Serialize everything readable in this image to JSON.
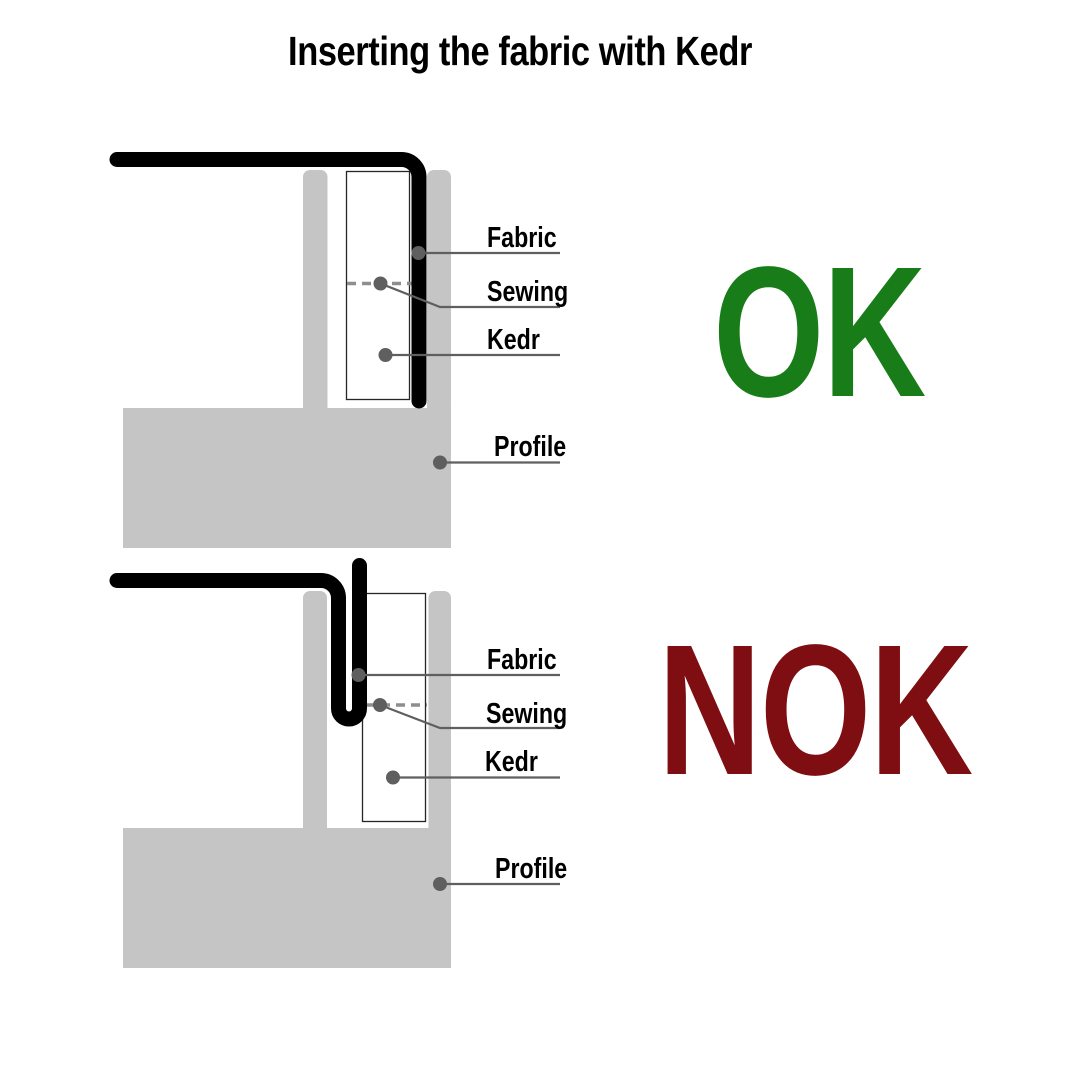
{
  "title": "Inserting the fabric with Kedr",
  "colors": {
    "background": "#ffffff",
    "fabric_black": "#000000",
    "profile_gray": "#c5c5c5",
    "kedr_border": "#262626",
    "leader_gray": "#5f5f5f",
    "dash_gray": "#8e8e8e",
    "ok_green": "#187d18",
    "nok_maroon": "#7e0e11"
  },
  "diagrams": [
    {
      "verdict": "OK",
      "labels": {
        "fabric": "Fabric",
        "sewing": "Sewing",
        "kedr": "Kedr",
        "profile": "Profile"
      }
    },
    {
      "verdict": "NOK",
      "labels": {
        "fabric": "Fabric",
        "sewing": "Sewing",
        "kedr": "Kedr",
        "profile": "Profile"
      }
    }
  ]
}
